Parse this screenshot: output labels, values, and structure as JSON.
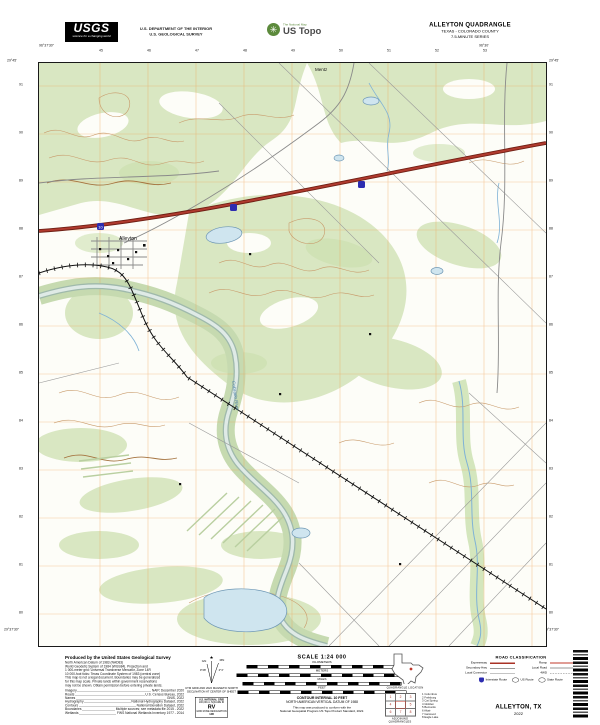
{
  "header": {
    "usgs_logo_text": "USGS",
    "usgs_tagline": "science for a changing world",
    "dept_line1": "U.S. DEPARTMENT OF THE INTERIOR",
    "dept_line2": "U.S. GEOLOGICAL SURVEY",
    "ustopo_tagline": "The National Map",
    "ustopo_name": "US Topo",
    "quad_name": "ALLEYTON QUADRANGLE",
    "quad_state_county": "TEXAS - COLORADO COUNTY",
    "quad_series": "7.5-MINUTE SERIES"
  },
  "map": {
    "top_ticks": [
      "45",
      "46",
      "47",
      "48",
      "49",
      "50",
      "51",
      "52",
      "53"
    ],
    "side_ticks": [
      "91",
      "90",
      "89",
      "88",
      "87",
      "86",
      "85",
      "84",
      "83",
      "82",
      "81",
      "80"
    ],
    "corners": {
      "tl_lon": "96°37'30\"",
      "tl_lat": "29°45'",
      "tr_lon": "96°30'",
      "tr_lat": "29°45'",
      "bl_lon": "96°37'30\"",
      "bl_lat": "29°37'30\"",
      "br_lon": "96°30'",
      "br_lat": "29°37'30\""
    },
    "labels": {
      "town": "Alleyton",
      "settlement": "Mentz",
      "river": "Colorado River",
      "interstate": "10"
    },
    "colors": {
      "forest": "#d9e7c2",
      "water_fill": "#cfe5ef",
      "water_line": "#6f98b5",
      "contour": "#c89a6a",
      "grid": "#f0a050",
      "highway": "#b03a2e",
      "highway_casing": "#6e1f14",
      "interstate_shield": "#2d2db0"
    }
  },
  "footer": {
    "credits_title": "Produced by the United States Geological Survey",
    "credits_lines": [
      "North American Datum of 1983 (NAD83)",
      "World Geodetic System of 1984 (WGS84).  Projection and",
      "1 000-meter grid: Universal Transverse Mercator, Zone 14R",
      "10 000-foot ticks: Texas Coordinate System of 1983 (central zone)",
      "This map is not a legal document. Boundaries may be generalized",
      "for this map scale. Private lands within government reservations",
      "may not be shown. Obtain permission before entering private lands."
    ],
    "credits_rows": [
      {
        "label": "Imagery",
        "value": "NAIP, December 2020"
      },
      {
        "label": "Roads",
        "value": "U.S. Census Bureau, 2022"
      },
      {
        "label": "Names",
        "value": "GNIS, 2022"
      },
      {
        "label": "Hydrography",
        "value": "National Hydrography Dataset, 2022"
      },
      {
        "label": "Contours",
        "value": "National Elevation Dataset, 2022"
      },
      {
        "label": "Boundaries",
        "value": "Multiple sources; see metadata file 2015 - 2022"
      },
      {
        "label": "Wetlands",
        "value": "FWS National Wetlands Inventory 1977 - 2014"
      }
    ],
    "declination": {
      "star": "★",
      "gn_label": "GN",
      "mn_label": "MN",
      "gn_angle": "0°28'",
      "mn_angle": "2°3'",
      "caption1": "UTM GRID AND 2022 MAGNETIC NORTH",
      "caption2": "DECLINATION AT CENTER OF SHEET"
    },
    "usng": {
      "title": "U.S. NATIONAL GRID",
      "sub": "100,000-m SQUARE ID",
      "square": "RV",
      "zone_label": "GRID ZONE DESIGNATION",
      "zone": "14R"
    },
    "scale": {
      "title": "SCALE 1:24 000",
      "units": [
        "KILOMETERS",
        "METERS",
        "MILES",
        "FEET"
      ],
      "contour_line1": "CONTOUR INTERVAL 10 FEET",
      "contour_line2": "NORTH AMERICAN VERTICAL DATUM OF 1988",
      "conform_line1": "This map was produced to conform with the",
      "conform_line2": "National Geospatial Program US Topo Product Standard, 2022."
    },
    "location": {
      "caption": "QUADRANGLE LOCATION"
    },
    "adjoining": {
      "caption": "ADJOINING QUADRANGLES",
      "numbers": [
        "1",
        "2",
        "3",
        "4",
        "5",
        "6",
        "7",
        "8"
      ],
      "names": [
        "1  Columbus",
        "2  Frelsburg",
        "3  Cat Spring",
        "4  Glidden",
        "5  Bernardo",
        "6  Altair",
        "7  Garwood",
        "8  Eagle Lake"
      ]
    },
    "road_class": {
      "title": "ROAD CLASSIFICATION",
      "classes": [
        "Expressway",
        "Ramp",
        "Secondary Hwy",
        "Local Road",
        "Local Connector",
        "4WD"
      ],
      "routes": [
        "Interstate Route",
        "US Route",
        "State Route"
      ]
    },
    "map_name_footer": "ALLEYTON, TX",
    "map_year": "2022"
  }
}
